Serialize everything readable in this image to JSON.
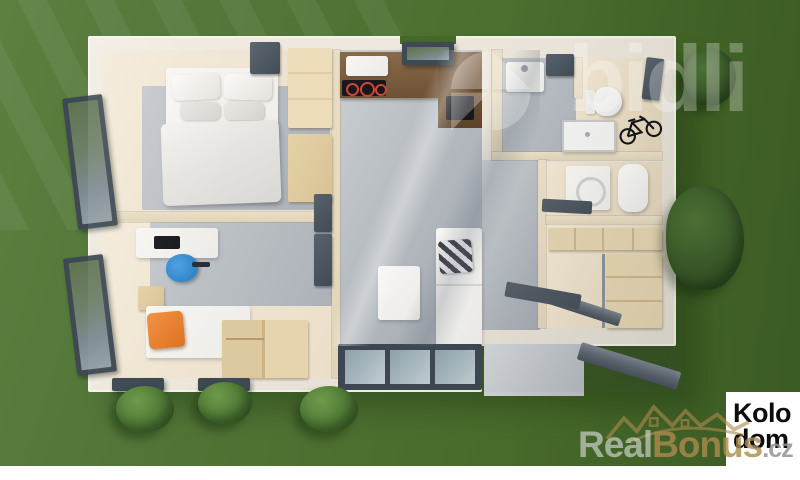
{
  "watermarks": {
    "bidli": {
      "text": "bidli",
      "color": "#ffffff",
      "opacity": 0.28
    },
    "realbonus": {
      "real": "Real",
      "bonus": "Bonus",
      "tld": ".cz",
      "real_color": "#e1e3e4",
      "bonus_color": "#ad8b4d",
      "tld_color": "#8c9397"
    }
  },
  "badge": {
    "line1": "Kolo",
    "line2": "dom",
    "bg": "#ffffff",
    "text_color": "#0c0c0c"
  },
  "palette": {
    "lawn": "#4d7031",
    "lawn_light": "#5d8040",
    "bush": "#56803a",
    "wall_exterior": "#ece6da",
    "wall_interior": "#e4d8bc",
    "floor_wood": "#ecdfca",
    "floor_concrete": "#b6bbc0",
    "kitchen_wood": "#7b5d3f",
    "cooktop": "#17181c",
    "cooktop_ring_red": "#cf4537",
    "frame_dark": "#3e4953",
    "furniture_white": "#f2f1ee",
    "accent_orange": "#e8802f",
    "accent_blue": "#2f8fd6"
  },
  "scene": {
    "type": "top-down 3d floor plan render of a single-storey house on a lawn",
    "rooms": [
      "bedroom",
      "kids-room-office",
      "living-room-kitchen",
      "hallway",
      "bathroom",
      "tech-room",
      "walk-in-closet",
      "entry"
    ],
    "furniture": [
      "double-bed",
      "wardrobe",
      "desk",
      "office-chair",
      "daybed",
      "storage-bench",
      "sofa",
      "coffee-table",
      "kitchen-counter",
      "cooktop",
      "kitchen-sink",
      "bathroom-sink",
      "toilet",
      "shower",
      "washing-machine",
      "water-heater",
      "bicycle",
      "closet-shelves"
    ]
  }
}
